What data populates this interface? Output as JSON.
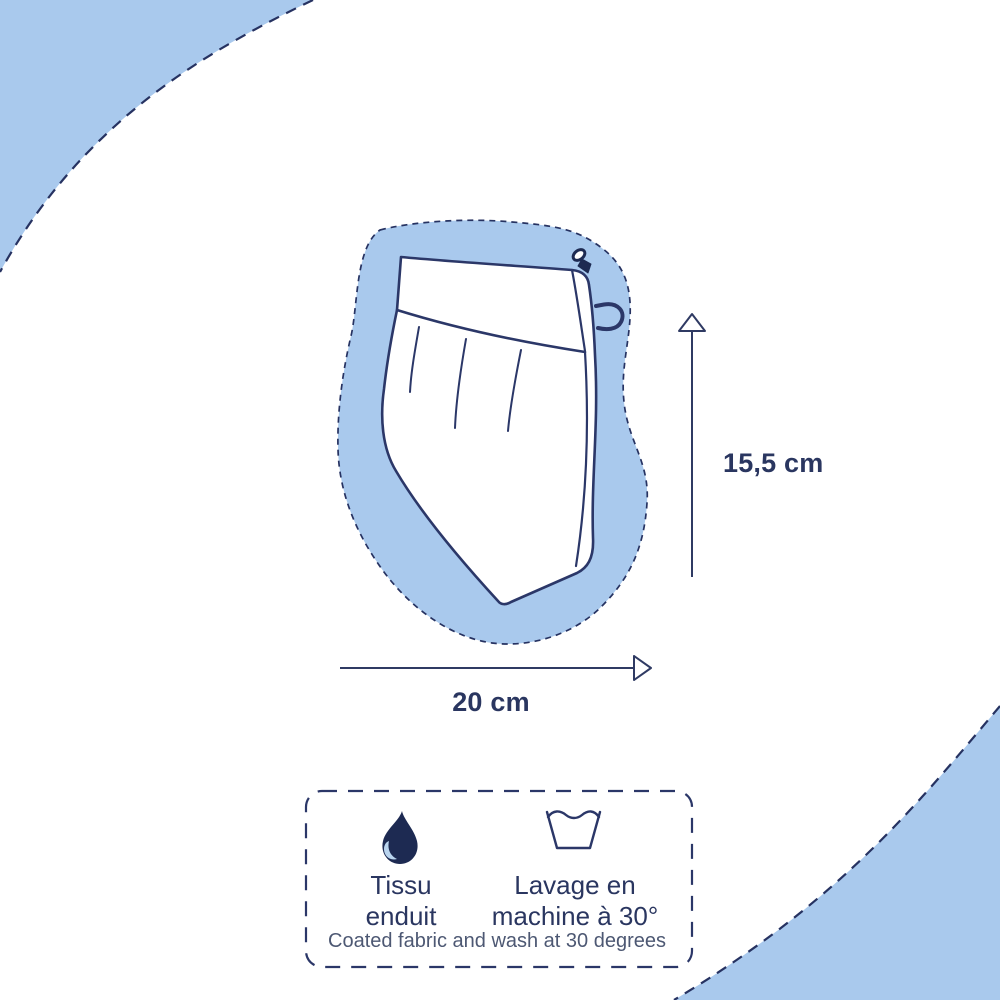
{
  "palette": {
    "background": "#ffffff",
    "light_blue": "#a9c9ed",
    "navy_line": "#263261",
    "drop_navy": "#1d2a52",
    "drop_highlight": "#b9d4ee",
    "text_navy": "#2a3660",
    "caption_gray": "#4d5873"
  },
  "product_diagram": {
    "height_label": "15,5 cm",
    "width_label": "20 cm",
    "icons": {
      "height_arrow": "up-arrow-icon",
      "width_arrow": "right-arrow-icon",
      "zipper": "zipper-pull-icon",
      "loop": "hanging-loop-icon"
    }
  },
  "care_panel": {
    "fabric": {
      "icon": "water-drop-icon",
      "line1": "Tissu",
      "line2": "enduit"
    },
    "wash": {
      "icon": "wash-basin-icon",
      "line1": "Lavage en",
      "line2": "machine à 30°"
    },
    "caption": "Coated fabric and wash at 30 degrees"
  }
}
